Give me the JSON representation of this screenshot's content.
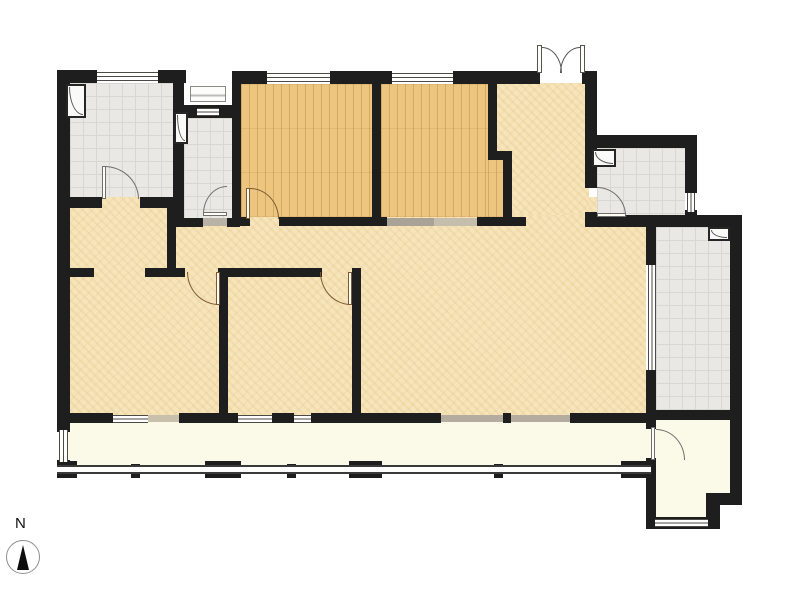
{
  "title": "apartment-floor-plan",
  "compass": {
    "label": "N"
  },
  "colors": {
    "wall": "#1e1e1e",
    "wood": "#ecc57e",
    "wood_line": "#d8a963",
    "cream": "#f6e4ba",
    "cream_line": "#e8cf9b",
    "gray": "#e9e8e4",
    "gray_line": "#d9d7d1",
    "balcony": "#fbf9e7",
    "window_line": "#4c4a45",
    "door_arc_brown": "#7a5a35",
    "door_arc_gray": "#6f6f6f"
  },
  "layers": {
    "floors": [
      {
        "name": "main-area-floor",
        "type": "cream",
        "x": 62,
        "y": 197,
        "w": 584,
        "h": 223
      },
      {
        "name": "entry-hall-floor",
        "type": "cream",
        "x": 497,
        "y": 83,
        "w": 92,
        "h": 132
      },
      {
        "name": "bathroom-1-floor",
        "type": "gray",
        "x": 70,
        "y": 83,
        "w": 103,
        "h": 114
      },
      {
        "name": "storage-room-floor",
        "type": "gray",
        "x": 184,
        "y": 118,
        "w": 48,
        "h": 100
      },
      {
        "name": "bathroom-2-floor",
        "type": "gray",
        "x": 597,
        "y": 148,
        "w": 88,
        "h": 67
      },
      {
        "name": "kitchen-floor",
        "type": "gray",
        "x": 656,
        "y": 227,
        "w": 74,
        "h": 183
      },
      {
        "name": "bedroom-1-floor",
        "type": "wood",
        "x": 241,
        "y": 84,
        "w": 131,
        "h": 133
      },
      {
        "name": "bedroom-2-floor",
        "type": "wood",
        "x": 381,
        "y": 84,
        "w": 107,
        "h": 133
      },
      {
        "name": "bedroom-2-floor-ext",
        "type": "wood",
        "x": 488,
        "y": 159,
        "w": 16,
        "h": 58
      },
      {
        "name": "balcony-floor",
        "type": "balcony",
        "x": 62,
        "y": 420,
        "w": 584,
        "h": 45
      },
      {
        "name": "balcony-ext-floor",
        "type": "balcony",
        "x": 656,
        "y": 420,
        "w": 74,
        "h": 85
      },
      {
        "name": "balcony-ext-floor-2",
        "type": "balcony",
        "x": 656,
        "y": 505,
        "w": 52,
        "h": 12
      },
      {
        "name": "balcony-ext-door-gap",
        "type": "balcony",
        "x": 646,
        "y": 429,
        "w": 10,
        "h": 29
      }
    ],
    "sills": [
      {
        "name": "window-sill",
        "x": 148,
        "y": 415,
        "w": 31,
        "h": 7,
        "color": "#c9c0ab"
      },
      {
        "name": "bedroom-2-threshold-a",
        "x": 387,
        "y": 218,
        "w": 47,
        "h": 8,
        "color": "#a8a297"
      },
      {
        "name": "bedroom-2-threshold-b",
        "x": 434,
        "y": 218,
        "w": 43,
        "h": 8,
        "color": "#c6beac"
      },
      {
        "name": "balcony-slider-sill",
        "x": 441,
        "y": 415,
        "w": 129,
        "h": 7,
        "color": "#b3ac9f"
      },
      {
        "name": "storage-threshold",
        "x": 203,
        "y": 218,
        "w": 24,
        "h": 8,
        "color": "#b9b2a6"
      }
    ],
    "walls": [
      {
        "x": 57,
        "y": 70,
        "w": 40,
        "h": 13
      },
      {
        "x": 158,
        "y": 70,
        "w": 28,
        "h": 13
      },
      {
        "x": 232,
        "y": 71,
        "w": 35,
        "h": 13
      },
      {
        "x": 330,
        "y": 71,
        "w": 62,
        "h": 13
      },
      {
        "x": 453,
        "y": 71,
        "w": 87,
        "h": 13
      },
      {
        "x": 582,
        "y": 71,
        "w": 15,
        "h": 13
      },
      {
        "x": 57,
        "y": 70,
        "w": 13,
        "h": 362
      },
      {
        "x": 57,
        "y": 460,
        "w": 13,
        "h": 18
      },
      {
        "x": 173,
        "y": 70,
        "w": 11,
        "h": 148
      },
      {
        "x": 176,
        "y": 105,
        "w": 64,
        "h": 13
      },
      {
        "x": 57,
        "y": 197,
        "w": 45,
        "h": 11
      },
      {
        "x": 140,
        "y": 197,
        "w": 44,
        "h": 11
      },
      {
        "x": 167,
        "y": 207,
        "w": 9,
        "h": 69
      },
      {
        "x": 176,
        "y": 218,
        "w": 27,
        "h": 9
      },
      {
        "x": 227,
        "y": 218,
        "w": 13,
        "h": 9
      },
      {
        "x": 232,
        "y": 71,
        "w": 9,
        "h": 155
      },
      {
        "x": 372,
        "y": 71,
        "w": 9,
        "h": 155
      },
      {
        "x": 240,
        "y": 217,
        "w": 10,
        "h": 9
      },
      {
        "x": 279,
        "y": 217,
        "w": 108,
        "h": 9
      },
      {
        "x": 477,
        "y": 217,
        "w": 49,
        "h": 9
      },
      {
        "x": 488,
        "y": 71,
        "w": 9,
        "h": 88
      },
      {
        "x": 488,
        "y": 151,
        "w": 24,
        "h": 9
      },
      {
        "x": 503,
        "y": 151,
        "w": 9,
        "h": 75
      },
      {
        "x": 585,
        "y": 71,
        "w": 12,
        "h": 77
      },
      {
        "x": 585,
        "y": 135,
        "w": 112,
        "h": 13
      },
      {
        "x": 585,
        "y": 148,
        "w": 12,
        "h": 40
      },
      {
        "x": 585,
        "y": 212,
        "w": 12,
        "h": 15
      },
      {
        "x": 685,
        "y": 148,
        "w": 12,
        "h": 45
      },
      {
        "x": 685,
        "y": 210,
        "w": 12,
        "h": 17
      },
      {
        "x": 585,
        "y": 215,
        "w": 157,
        "h": 12
      },
      {
        "x": 730,
        "y": 215,
        "w": 12,
        "h": 285
      },
      {
        "x": 706,
        "y": 493,
        "w": 36,
        "h": 12
      },
      {
        "x": 706,
        "y": 505,
        "w": 14,
        "h": 24
      },
      {
        "x": 646,
        "y": 517,
        "w": 64,
        "h": 12
      },
      {
        "x": 646,
        "y": 223,
        "w": 10,
        "h": 42
      },
      {
        "x": 646,
        "y": 370,
        "w": 10,
        "h": 50
      },
      {
        "x": 646,
        "y": 410,
        "w": 96,
        "h": 10
      },
      {
        "x": 646,
        "y": 420,
        "w": 10,
        "h": 9
      },
      {
        "x": 646,
        "y": 458,
        "w": 10,
        "h": 20
      },
      {
        "x": 646,
        "y": 478,
        "w": 10,
        "h": 45
      },
      {
        "x": 62,
        "y": 268,
        "w": 32,
        "h": 9
      },
      {
        "x": 145,
        "y": 268,
        "w": 40,
        "h": 9
      },
      {
        "x": 218,
        "y": 268,
        "w": 104,
        "h": 9
      },
      {
        "x": 352,
        "y": 268,
        "w": 9,
        "h": 150
      },
      {
        "x": 219,
        "y": 276,
        "w": 9,
        "h": 140
      },
      {
        "x": 57,
        "y": 413,
        "w": 56,
        "h": 10
      },
      {
        "x": 179,
        "y": 413,
        "w": 59,
        "h": 10
      },
      {
        "x": 272,
        "y": 413,
        "w": 22,
        "h": 10
      },
      {
        "x": 311,
        "y": 413,
        "w": 130,
        "h": 10
      },
      {
        "x": 570,
        "y": 413,
        "w": 78,
        "h": 10
      },
      {
        "x": 503,
        "y": 413,
        "w": 8,
        "h": 10
      },
      {
        "x": 57,
        "y": 461,
        "w": 20,
        "h": 17
      },
      {
        "x": 131,
        "y": 464,
        "w": 9,
        "h": 14
      },
      {
        "x": 205,
        "y": 461,
        "w": 36,
        "h": 17
      },
      {
        "x": 287,
        "y": 464,
        "w": 9,
        "h": 14
      },
      {
        "x": 349,
        "y": 461,
        "w": 33,
        "h": 17
      },
      {
        "x": 494,
        "y": 464,
        "w": 9,
        "h": 14
      },
      {
        "x": 621,
        "y": 461,
        "w": 31,
        "h": 17
      }
    ],
    "windows": [
      {
        "name": "window-bathroom-1",
        "orient": "h",
        "x": 97,
        "y": 72,
        "w": 61,
        "h": 9
      },
      {
        "name": "window-niche",
        "orient": "h",
        "x": 197,
        "y": 108,
        "w": 22,
        "h": 8
      },
      {
        "name": "window-bedroom-1",
        "orient": "h",
        "x": 267,
        "y": 73,
        "w": 63,
        "h": 9
      },
      {
        "name": "window-bedroom-2",
        "orient": "h",
        "x": 392,
        "y": 73,
        "w": 61,
        "h": 9
      },
      {
        "name": "window-room-a",
        "orient": "h",
        "x": 113,
        "y": 415,
        "w": 35,
        "h": 8
      },
      {
        "name": "window-room-b",
        "orient": "h",
        "x": 238,
        "y": 415,
        "w": 34,
        "h": 8
      },
      {
        "name": "window-room-c",
        "orient": "h",
        "x": 294,
        "y": 415,
        "w": 17,
        "h": 8
      },
      {
        "name": "window-balcony-ext",
        "orient": "h",
        "x": 655,
        "y": 519,
        "w": 53,
        "h": 8
      },
      {
        "name": "window-balcony-left",
        "orient": "v",
        "x": 59,
        "y": 430,
        "w": 9,
        "h": 32
      },
      {
        "name": "window-bathroom-2",
        "orient": "v",
        "x": 687,
        "y": 193,
        "w": 8,
        "h": 19
      },
      {
        "name": "kitchen-sliding-door",
        "orient": "v",
        "x": 648,
        "y": 265,
        "w": 8,
        "h": 105
      }
    ],
    "rails": [
      {
        "name": "balcony-railing",
        "x": 57,
        "y": 465,
        "w": 594,
        "h": 9
      }
    ],
    "doors": [
      {
        "name": "bathroom-1-door",
        "color": "#6f6f6f",
        "arc": {
          "x": 104,
          "y": 166,
          "w": 35,
          "h": 33,
          "corner": "tr"
        },
        "leaf": {
          "x": 102,
          "y": 166,
          "w": 4,
          "h": 33
        }
      },
      {
        "name": "storage-door",
        "color": "#6f6f6f",
        "arc": {
          "x": 203,
          "y": 186,
          "w": 24,
          "h": 28,
          "corner": "tl"
        },
        "leaf": {
          "x": 203,
          "y": 212,
          "w": 24,
          "h": 4
        }
      },
      {
        "name": "bedroom-1-door",
        "color": "#7a5a35",
        "arc": {
          "x": 250,
          "y": 188,
          "w": 29,
          "h": 31,
          "corner": "tr"
        },
        "leaf": {
          "x": 246,
          "y": 188,
          "w": 4,
          "h": 31
        }
      },
      {
        "name": "room-a-door",
        "color": "#7a5a35",
        "arc": {
          "x": 187,
          "y": 272,
          "w": 32,
          "h": 33,
          "corner": "bl"
        },
        "leaf": {
          "x": 216,
          "y": 272,
          "w": 4,
          "h": 33
        }
      },
      {
        "name": "room-b-door",
        "color": "#7a5a35",
        "arc": {
          "x": 320,
          "y": 272,
          "w": 31,
          "h": 33,
          "corner": "bl"
        },
        "leaf": {
          "x": 348,
          "y": 272,
          "w": 4,
          "h": 33
        }
      },
      {
        "name": "bathroom-2-door",
        "color": "#6f6f6f",
        "arc": {
          "x": 597,
          "y": 187,
          "w": 29,
          "h": 29,
          "corner": "tr"
        },
        "leaf": {
          "x": 597,
          "y": 213,
          "w": 29,
          "h": 4
        }
      },
      {
        "name": "balcony-ext-door",
        "color": "#6f6f6f",
        "arc": {
          "x": 656,
          "y": 429,
          "w": 29,
          "h": 31,
          "corner": "tr"
        },
        "leaf": {
          "x": 651,
          "y": 427,
          "w": 4,
          "h": 33
        }
      },
      {
        "name": "entrance-door-left",
        "color": "#555555",
        "arc": {
          "x": 542,
          "y": 47,
          "w": 20,
          "h": 26,
          "corner": "tr"
        },
        "leaf": {
          "x": 537,
          "y": 45,
          "w": 5,
          "h": 28
        }
      },
      {
        "name": "entrance-door-right",
        "color": "#555555",
        "arc": {
          "x": 560,
          "y": 47,
          "w": 20,
          "h": 26,
          "corner": "tl"
        },
        "leaf": {
          "x": 580,
          "y": 45,
          "w": 5,
          "h": 28
        }
      }
    ],
    "flues": [
      {
        "x": 66,
        "y": 84,
        "w": 20,
        "h": 34
      },
      {
        "x": 174,
        "y": 112,
        "w": 14,
        "h": 32
      },
      {
        "x": 592,
        "y": 149,
        "w": 24,
        "h": 18
      },
      {
        "x": 708,
        "y": 227,
        "w": 22,
        "h": 14
      }
    ],
    "appliances": [
      {
        "name": "ac-outdoor-unit",
        "x": 190,
        "y": 86,
        "w": 36,
        "h": 16
      }
    ]
  }
}
